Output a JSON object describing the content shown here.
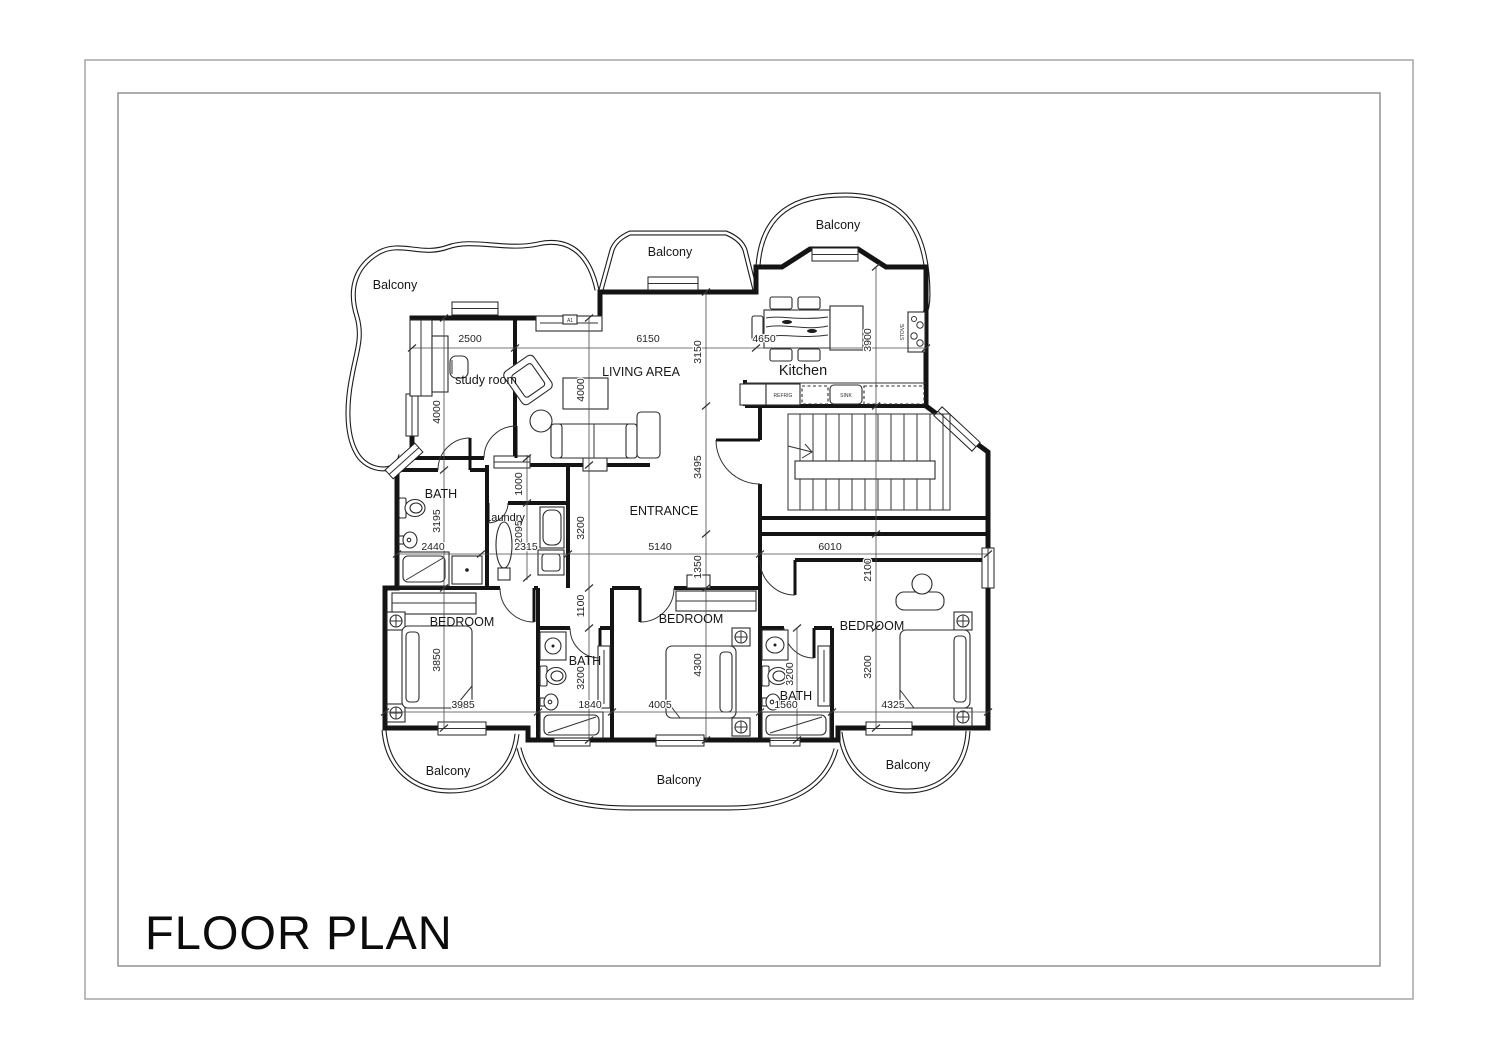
{
  "page": {
    "title": "FLOOR PLAN"
  },
  "plan": {
    "balconies": [
      "Balcony",
      "Balcony",
      "Balcony",
      "Balcony",
      "Balcony",
      "Balcony"
    ],
    "rooms": {
      "study": "study room",
      "living": "LIVING AREA",
      "kitchen": "Kitchen",
      "entrance": "ENTRANCE",
      "laundry": "Laundry",
      "baths": [
        "BATH",
        "BATH",
        "BATH"
      ],
      "bedrooms": [
        "BEDROOM",
        "BEDROOM",
        "BEDROOM"
      ]
    },
    "appliances": {
      "fridge": "REFRIG",
      "sink": "SINK",
      "stove": "STOVE"
    },
    "marker": "A1",
    "dims": {
      "study_w": "2500",
      "living_w": "6150",
      "kitchen_w": "4650",
      "living_h": "3150",
      "kitchen_d": "3900",
      "study_h": "4000",
      "living_d": "4000",
      "hall_w": "1000",
      "laundry_h": "2095",
      "bath1_h": "3195",
      "laundry_col": "3200",
      "entrance_h": "3495",
      "bath1_w": "2440",
      "laundry_w": "2315",
      "entrance_w": "5140",
      "hall_right_w": "6010",
      "entrance_col": "1350",
      "bed3_top": "2100",
      "corridor": "1100",
      "bed1_h": "3850",
      "bed2_h": "4300",
      "bed3_h": "3200",
      "bath2_h": "3200",
      "bath3_h": "3200",
      "bed1_w": "3985",
      "bath2_w": "1840",
      "bed2_w": "4005",
      "bath3_w": "1560",
      "bed3_w": "4325"
    }
  }
}
